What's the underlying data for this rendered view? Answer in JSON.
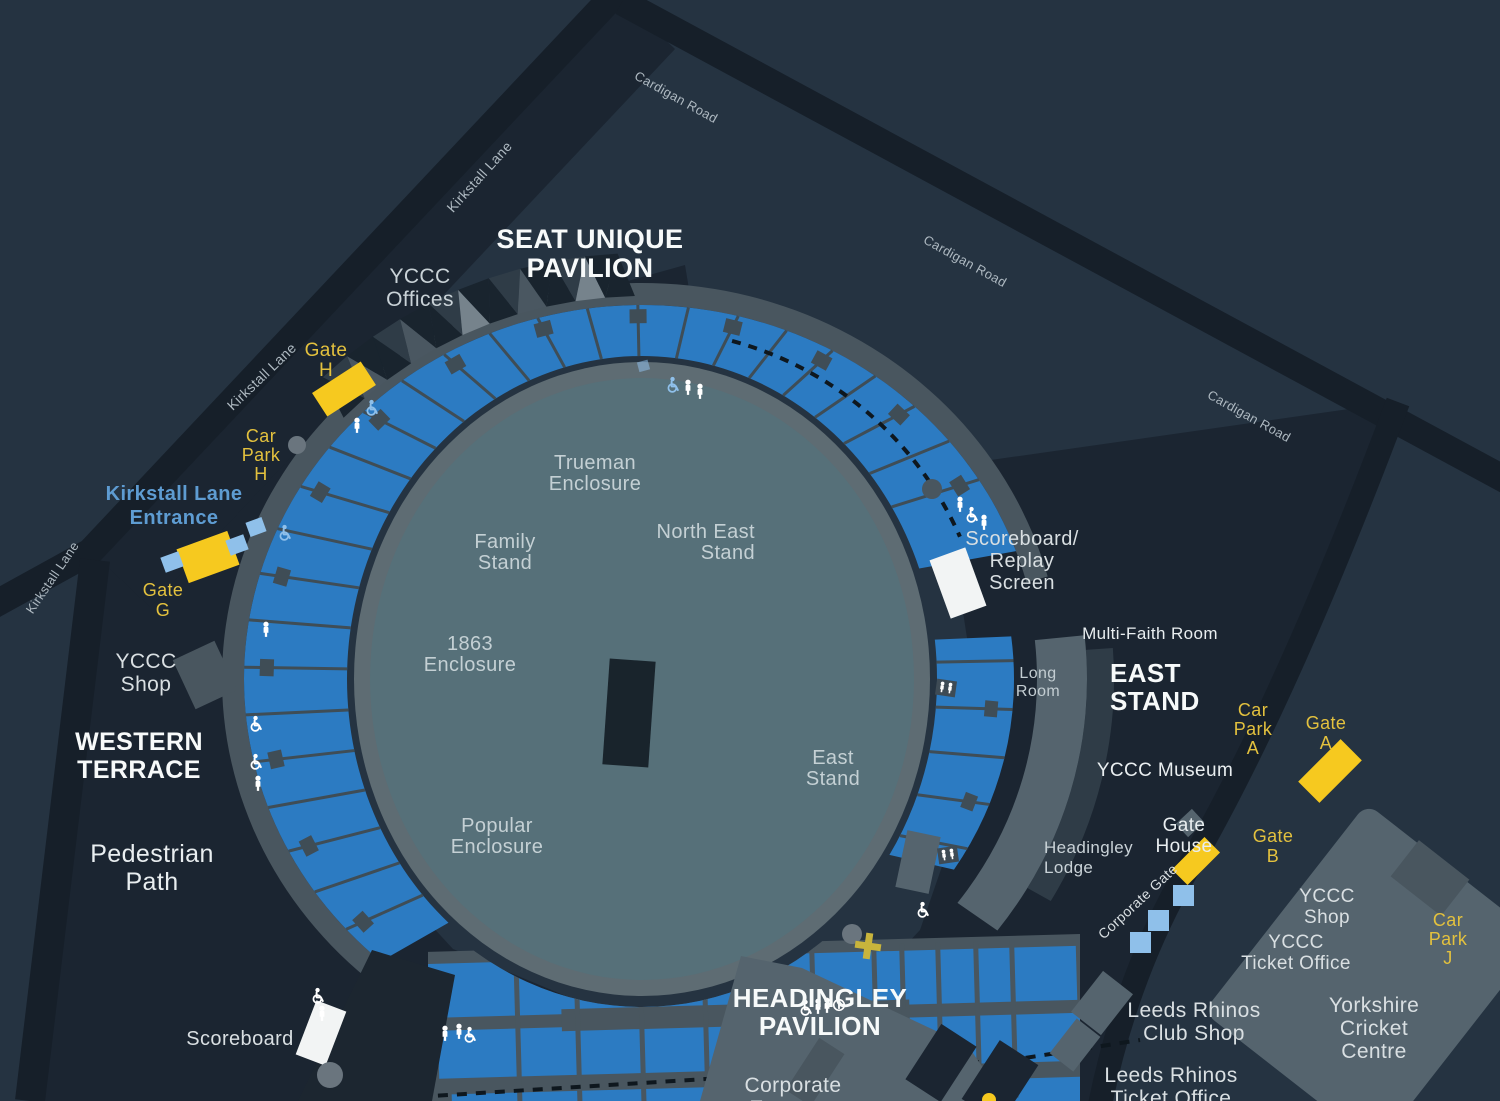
{
  "title": "Headingley Stadium ground map",
  "theme": {
    "bg": "#253341",
    "site_dark": "#1B2531",
    "road": "#161F29",
    "field": "#567079",
    "walkway": "#5E6C73",
    "seats_blue": "#2C7BC2",
    "divider": "#3F4D56",
    "outer_band": "#49565F",
    "building_light": "#55646E",
    "building_mid": "#49565F",
    "building_step": "#2F3C47",
    "roof_dark": "#19242E",
    "roof_mid": "#4A5761",
    "roof_light": "#76838C",
    "pitch": "#19242C",
    "white_marker": "#F2F4F4",
    "gate_yellow": "#F6C91F",
    "yellow_text": "#E3C13E",
    "light_blue": "#8FC0EA",
    "blue_text": "#5E9CD2",
    "road_text": "#AEB9C1",
    "field_text": "#C4D0D4",
    "label_text": "#D9DFE2",
    "bright_text": "#F7FAFA",
    "dashed_line": "#0E171E"
  },
  "labels": [
    {
      "id": "seat-unique-pavilion",
      "lines": [
        "SEAT UNIQUE",
        "PAVILION"
      ],
      "x": 590,
      "y": 248,
      "size": 27,
      "color": "#F7FAFA",
      "bold": true,
      "lh": 29
    },
    {
      "id": "yccc-offices",
      "lines": [
        "YCCC",
        "Offices"
      ],
      "x": 420,
      "y": 283,
      "size": 21,
      "color": "#C9D2D7",
      "lh": 23
    },
    {
      "id": "kirkstall-lane-top",
      "lines": [
        "Kirkstall Lane"
      ],
      "x": 483,
      "y": 180,
      "size": 14,
      "color": "#AEB9C1",
      "rotate": -48
    },
    {
      "id": "kirkstall-lane-mid",
      "lines": [
        "Kirkstall Lane"
      ],
      "x": 265,
      "y": 380,
      "size": 14,
      "color": "#AEB9C1",
      "rotate": -44
    },
    {
      "id": "kirkstall-lane-left",
      "lines": [
        "Kirkstall Lane"
      ],
      "x": 56,
      "y": 580,
      "size": 13,
      "color": "#AEB9C1",
      "rotate": -56
    },
    {
      "id": "cardigan-road-1",
      "lines": [
        "Cardigan Road"
      ],
      "x": 674,
      "y": 101,
      "size": 13,
      "color": "#AEB9C1",
      "rotate": 29
    },
    {
      "id": "cardigan-road-2",
      "lines": [
        "Cardigan Road"
      ],
      "x": 963,
      "y": 265,
      "size": 13,
      "color": "#AEB9C1",
      "rotate": 29
    },
    {
      "id": "cardigan-road-3",
      "lines": [
        "Cardigan Road"
      ],
      "x": 1247,
      "y": 420,
      "size": 13,
      "color": "#AEB9C1",
      "rotate": 29
    },
    {
      "id": "gate-h",
      "lines": [
        "Gate",
        "H"
      ],
      "x": 326,
      "y": 356,
      "size": 19,
      "color": "#E3C13E",
      "lh": 20
    },
    {
      "id": "car-park-h",
      "lines": [
        "Car",
        "Park",
        "H"
      ],
      "x": 261,
      "y": 442,
      "size": 18,
      "color": "#E3C13E",
      "lh": 19
    },
    {
      "id": "kirkstall-lane-entrance",
      "lines": [
        "Kirkstall Lane",
        "Entrance"
      ],
      "x": 174,
      "y": 500,
      "size": 20,
      "color": "#5E9CD2",
      "bold": true,
      "lh": 24
    },
    {
      "id": "gate-g",
      "lines": [
        "Gate",
        "G"
      ],
      "x": 163,
      "y": 596,
      "size": 18,
      "color": "#E3C13E",
      "lh": 20
    },
    {
      "id": "yccc-shop-west",
      "lines": [
        "YCCC",
        "Shop"
      ],
      "x": 146,
      "y": 668,
      "size": 21,
      "color": "#D9DFE2",
      "lh": 23
    },
    {
      "id": "western-terrace",
      "lines": [
        "WESTERN",
        "TERRACE"
      ],
      "x": 139,
      "y": 750,
      "size": 25,
      "color": "#F7FAFA",
      "bold": true,
      "lh": 28
    },
    {
      "id": "pedestrian-path",
      "lines": [
        "Pedestrian",
        "Path"
      ],
      "x": 152,
      "y": 862,
      "size": 25,
      "color": "#E9EEF0",
      "lh": 28
    },
    {
      "id": "scoreboard-sw",
      "lines": [
        "Scoreboard"
      ],
      "x": 240,
      "y": 1045,
      "size": 20,
      "color": "#D9DFE2"
    },
    {
      "id": "trueman-enclosure",
      "lines": [
        "Trueman",
        "Enclosure"
      ],
      "x": 595,
      "y": 469,
      "size": 20,
      "color": "#C4D0D4",
      "lh": 21
    },
    {
      "id": "family-stand",
      "lines": [
        "Family",
        "Stand"
      ],
      "x": 505,
      "y": 548,
      "size": 20,
      "color": "#C4D0D4",
      "lh": 21
    },
    {
      "id": "north-east-stand",
      "lines": [
        "North East",
        "Stand"
      ],
      "x": 755,
      "y": 538,
      "size": 20,
      "color": "#C4D0D4",
      "lh": 21,
      "anchor": "end"
    },
    {
      "id": "enclosure-1863",
      "lines": [
        "1863",
        "Enclosure"
      ],
      "x": 470,
      "y": 650,
      "size": 20,
      "color": "#C4D0D4",
      "lh": 21
    },
    {
      "id": "east-stand-field",
      "lines": [
        "East",
        "Stand"
      ],
      "x": 833,
      "y": 764,
      "size": 20,
      "color": "#C4D0D4",
      "lh": 21
    },
    {
      "id": "popular-enclosure",
      "lines": [
        "Popular",
        "Enclosure"
      ],
      "x": 497,
      "y": 832,
      "size": 20,
      "color": "#C4D0D4",
      "lh": 21
    },
    {
      "id": "scoreboard-replay",
      "lines": [
        "Scoreboard/",
        "Replay",
        "Screen"
      ],
      "x": 1022,
      "y": 545,
      "size": 20,
      "color": "#D9DFE2",
      "lh": 22
    },
    {
      "id": "multi-faith-room",
      "lines": [
        "Multi-Faith Room"
      ],
      "x": 1150,
      "y": 639,
      "size": 17,
      "color": "#E9EEF0"
    },
    {
      "id": "long-room",
      "lines": [
        "Long",
        "Room"
      ],
      "x": 1038,
      "y": 678,
      "size": 16,
      "color": "#C3CDD2",
      "lh": 18
    },
    {
      "id": "east-stand",
      "lines": [
        "EAST",
        "STAND"
      ],
      "x": 1110,
      "y": 682,
      "size": 26,
      "color": "#F7FAFA",
      "bold": true,
      "lh": 28,
      "anchor": "start"
    },
    {
      "id": "car-park-a",
      "lines": [
        "Car",
        "Park",
        "A"
      ],
      "x": 1253,
      "y": 716,
      "size": 18,
      "color": "#E3C13E",
      "lh": 19
    },
    {
      "id": "gate-a",
      "lines": [
        "Gate",
        "A"
      ],
      "x": 1326,
      "y": 729,
      "size": 18,
      "color": "#E3C13E",
      "lh": 20
    },
    {
      "id": "yccc-museum",
      "lines": [
        "YCCC Museum"
      ],
      "x": 1165,
      "y": 776,
      "size": 19,
      "color": "#E9EEF0"
    },
    {
      "id": "gate-house",
      "lines": [
        "Gate",
        "House"
      ],
      "x": 1184,
      "y": 831,
      "size": 19,
      "color": "#E9EEF0",
      "lh": 21
    },
    {
      "id": "headingley-lodge",
      "lines": [
        "Headingley",
        "Lodge"
      ],
      "x": 1044,
      "y": 853,
      "size": 17,
      "color": "#C9D2D7",
      "lh": 20,
      "anchor": "start"
    },
    {
      "id": "gate-b",
      "lines": [
        "Gate",
        "B"
      ],
      "x": 1273,
      "y": 842,
      "size": 18,
      "color": "#E3C13E",
      "lh": 20
    },
    {
      "id": "corporate-gate",
      "lines": [
        "Corporate Gate"
      ],
      "x": 1141,
      "y": 905,
      "size": 14,
      "color": "#D9DFE2",
      "rotate": -43
    },
    {
      "id": "yccc-shop-se",
      "lines": [
        "YCCC",
        "Shop"
      ],
      "x": 1327,
      "y": 902,
      "size": 19,
      "color": "#D9DFE2",
      "lh": 21
    },
    {
      "id": "yccc-ticket-office",
      "lines": [
        "YCCC",
        "Ticket Office"
      ],
      "x": 1296,
      "y": 948,
      "size": 19,
      "color": "#D9DFE2",
      "lh": 21
    },
    {
      "id": "car-park-j",
      "lines": [
        "Car",
        "Park",
        "J"
      ],
      "x": 1448,
      "y": 926,
      "size": 18,
      "color": "#E3C13E",
      "lh": 19
    },
    {
      "id": "leeds-rhinos-club-shop",
      "lines": [
        "Leeds Rhinos",
        "Club Shop"
      ],
      "x": 1194,
      "y": 1017,
      "size": 21,
      "color": "#D9DFE2",
      "lh": 23
    },
    {
      "id": "yorkshire-cricket-centre",
      "lines": [
        "Yorkshire",
        "Cricket",
        "Centre"
      ],
      "x": 1374,
      "y": 1012,
      "size": 21,
      "color": "#D9DFE2",
      "lh": 23
    },
    {
      "id": "leeds-rhinos-ticket-office",
      "lines": [
        "Leeds Rhinos",
        "Ticket Office"
      ],
      "x": 1171,
      "y": 1082,
      "size": 21,
      "color": "#D9DFE2",
      "lh": 23
    },
    {
      "id": "headingley-pavilion",
      "lines": [
        "HEADINGLEY",
        "PAVILION"
      ],
      "x": 820,
      "y": 1007,
      "size": 26,
      "color": "#F7FAFA",
      "bold": true,
      "lh": 28
    },
    {
      "id": "corporate-entrance",
      "lines": [
        "Corporate",
        "Entrance"
      ],
      "x": 793,
      "y": 1092,
      "size": 21,
      "color": "#D9DFE2",
      "lh": 23
    }
  ],
  "icons": [
    {
      "t": "wheelchair-icon",
      "x": 372,
      "y": 408,
      "c": "#8FC0EA"
    },
    {
      "t": "person-icon",
      "x": 357,
      "y": 426,
      "c": "#FFFFFF"
    },
    {
      "t": "wheelchair-icon",
      "x": 285,
      "y": 533,
      "c": "#8FC0EA"
    },
    {
      "t": "person-icon",
      "x": 266,
      "y": 630,
      "c": "#FFFFFF"
    },
    {
      "t": "wheelchair-icon",
      "x": 256,
      "y": 724,
      "c": "#FFFFFF"
    },
    {
      "t": "wheelchair-icon",
      "x": 256,
      "y": 762,
      "c": "#FFFFFF"
    },
    {
      "t": "person-icon",
      "x": 258,
      "y": 784,
      "c": "#FFFFFF"
    },
    {
      "t": "wheelchair-icon",
      "x": 318,
      "y": 996,
      "c": "#FFFFFF"
    },
    {
      "t": "person-icon",
      "x": 322,
      "y": 1014,
      "c": "#FFFFFF"
    },
    {
      "t": "wheelchair-icon",
      "x": 673,
      "y": 385,
      "c": "#8FC0EA"
    },
    {
      "t": "person-icon",
      "x": 688,
      "y": 388,
      "c": "#FFFFFF"
    },
    {
      "t": "person-icon",
      "x": 700,
      "y": 392,
      "c": "#FFFFFF"
    },
    {
      "t": "person-icon",
      "x": 960,
      "y": 505,
      "c": "#FFFFFF"
    },
    {
      "t": "wheelchair-icon",
      "x": 972,
      "y": 515,
      "c": "#FFFFFF"
    },
    {
      "t": "person-icon",
      "x": 984,
      "y": 523,
      "c": "#FFFFFF"
    },
    {
      "t": "wheelchair-icon",
      "x": 923,
      "y": 910,
      "c": "#FFFFFF"
    },
    {
      "t": "wheelchair-icon",
      "x": 806,
      "y": 1008,
      "c": "#FFFFFF"
    },
    {
      "t": "person-icon",
      "x": 818,
      "y": 1007,
      "c": "#FFFFFF"
    },
    {
      "t": "person-icon",
      "x": 827,
      "y": 1006,
      "c": "#FFFFFF"
    },
    {
      "t": "info-icon",
      "x": 839,
      "y": 1005,
      "c": "#FFFFFF"
    },
    {
      "t": "person-icon",
      "x": 445,
      "y": 1034,
      "c": "#FFFFFF"
    },
    {
      "t": "person-icon",
      "x": 459,
      "y": 1032,
      "c": "#FFFFFF"
    },
    {
      "t": "wheelchair-icon",
      "x": 470,
      "y": 1035,
      "c": "#FFFFFF"
    }
  ]
}
